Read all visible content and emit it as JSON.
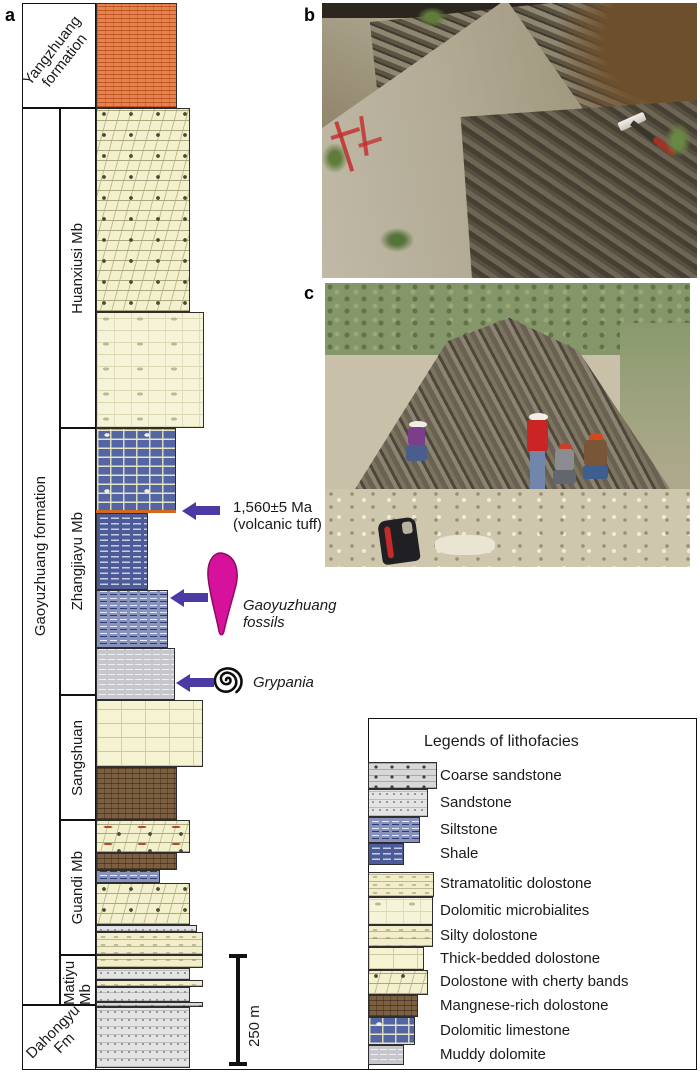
{
  "figure": {
    "panel_a": "a",
    "panel_b": "b",
    "panel_c": "c"
  },
  "stratigraphy": {
    "formations": {
      "yangzhuang": "Yangzhuang formation",
      "gaoyuzhuang": "Gaoyuzhuang formation",
      "dahongyu": "Dahongyu Fm"
    },
    "members": [
      "Huanxiusi Mb",
      "Zhangjiayu Mb",
      "Sangshuan",
      "Guandi Mb",
      "Matiyu Mb"
    ],
    "layers": [
      {
        "y": 3,
        "h": 105,
        "lith": "Yangzhuang dolomite (orange brick pattern)"
      },
      {
        "y": 108,
        "h": 204,
        "lith": "Dolostone with cherty bands"
      },
      {
        "y": 312,
        "h": 116,
        "lith": "Dolomitic microbialites"
      },
      {
        "y": 428,
        "h": 85,
        "lith": "Dolomitic limestone"
      },
      {
        "y": 513,
        "h": 77,
        "lith": "Shale"
      },
      {
        "y": 590,
        "h": 58,
        "lith": "Siltstone"
      },
      {
        "y": 648,
        "h": 52,
        "lith": "Muddy dolomite"
      },
      {
        "y": 700,
        "h": 67,
        "lith": "Thick-bedded dolostone"
      },
      {
        "y": 767,
        "h": 53,
        "lith": "Mangnese-rich dolostone"
      },
      {
        "y": 820,
        "h": 33,
        "lith": "Dolostone with cherty bands"
      },
      {
        "y": 853,
        "h": 17,
        "lith": "Mangnese-rich dolostone"
      },
      {
        "y": 870,
        "h": 13,
        "lith": "Siltstone"
      },
      {
        "y": 883,
        "h": 42,
        "lith": "Dolostone with cherty bands"
      },
      {
        "y": 925,
        "h": 7,
        "lith": "Sandstone"
      },
      {
        "y": 932,
        "h": 23,
        "lith": "Stramatolitic dolostone"
      },
      {
        "y": 955,
        "h": 13,
        "lith": "Silty dolostone"
      },
      {
        "y": 968,
        "h": 12,
        "lith": "Sandstone"
      },
      {
        "y": 980,
        "h": 7,
        "lith": "Silty dolostone"
      },
      {
        "y": 987,
        "h": 15,
        "lith": "Sandstone"
      },
      {
        "y": 1002,
        "h": 5,
        "lith": "Coarse sandstone"
      },
      {
        "y": 1007,
        "h": 61,
        "lith": "Sandstone"
      }
    ]
  },
  "annotations": {
    "tuff_age": "1,560±5 Ma",
    "tuff_note": "(volcanic tuff)",
    "fossil_label_line1": "Gaoyuzhuang",
    "fossil_label_line2": "fossils",
    "grypania_label": "Grypania",
    "scale_bar": "250 m"
  },
  "legend": {
    "title": "Legends of lithofacies",
    "items": [
      {
        "label": "Coarse sandstone"
      },
      {
        "label": "Sandstone"
      },
      {
        "label": "Siltstone"
      },
      {
        "label": "Shale"
      },
      {
        "label": "Stramatolitic dolostone"
      },
      {
        "label": "Dolomitic microbialites"
      },
      {
        "label": "Silty dolostone"
      },
      {
        "label": "Thick-bedded dolostone"
      },
      {
        "label": "Dolostone with cherty bands"
      },
      {
        "label": "Mangnese-rich dolostone"
      },
      {
        "label": "Dolomitic limestone"
      },
      {
        "label": "Muddy dolomite"
      }
    ]
  },
  "colors": {
    "arrow": "#4B3AA3",
    "fossil_magenta": "#D6119B",
    "tuff_marker": "#D2691E",
    "yangzhuang_fill": "#E8824E",
    "dolostone_fill": "#F3F0CD",
    "dolomitic_limestone_fill": "#5465A6",
    "shale_fill": "#4D5C98",
    "siltstone_fill": "#8793BC",
    "muddy_dolomite_fill": "#C6C6CC",
    "manganese_fill": "#7C5F40",
    "sandstone_fill": "#E3E3E3"
  }
}
